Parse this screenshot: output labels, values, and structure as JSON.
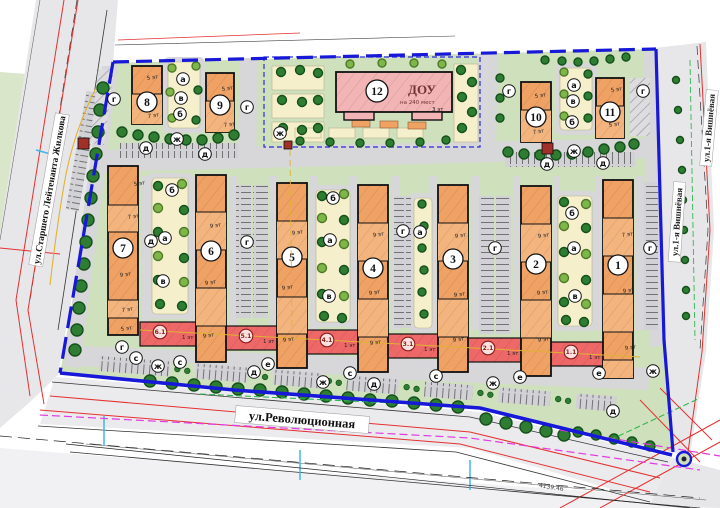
{
  "streets": {
    "left": "ул.Старшего Лейтенанта Жилкова",
    "bottom": "ул.Революционная",
    "right_lower": "ул.1-я Вишнёвая",
    "right_upper": "ул.1-я Вишнёвая"
  },
  "dimension_note": "4139.46",
  "dou": {
    "number": "12",
    "name": "ДОУ",
    "capacity": "на 240 мест",
    "floors": "3 эт"
  },
  "colors": {
    "site_green": "#cfe0bd",
    "light_green": "#dce8cc",
    "courtyard_cream": "#f5efcb",
    "building_orange": "#f0a164",
    "building_orange_light": "#f3b47e",
    "building_pink": "#f2b4b4",
    "commercial_red": "#ee6868",
    "boundary_blue": "#1718d8",
    "fence_blue": "#2a2ae0",
    "road_gray": "#d7d7da",
    "street_gray": "#e7e7ea",
    "tree_dark": "#2f7d32",
    "tree_dark_edge": "#14501a",
    "tree_light": "#7fb649",
    "tree_light_edge": "#4d7a28",
    "tp_red": "#a03028",
    "utility_red": "#e53030",
    "utility_magenta": "#e23ae2",
    "utility_yellow": "#e0b232",
    "utility_cyan": "#3fb6e8",
    "utility_green": "#2eb84e"
  },
  "plan": {
    "lanes": [
      142,
      188,
      230,
      270,
      310,
      350,
      392,
      430,
      472,
      513,
      553,
      595,
      636
    ],
    "courts": [
      [
        152,
        178,
        36,
        136
      ],
      [
        316,
        190,
        34,
        132
      ],
      [
        414,
        198,
        18,
        130
      ],
      [
        558,
        196,
        34,
        130
      ],
      [
        168,
        62,
        32,
        66
      ],
      [
        560,
        68,
        32,
        62
      ]
    ],
    "buildings": [
      {
        "id": "b7",
        "label": "7",
        "x": 108,
        "y": 166,
        "w": 30,
        "h": 169,
        "divs": [
          205,
          232,
          300,
          318
        ],
        "cx": 123,
        "cy": 248
      },
      {
        "id": "b6",
        "label": "6",
        "x": 196,
        "y": 175,
        "w": 30,
        "h": 187,
        "divs": [
          212,
          250,
          288,
          326
        ],
        "cx": 211,
        "cy": 251
      },
      {
        "id": "b5",
        "label": "5",
        "x": 277,
        "y": 183,
        "w": 30,
        "h": 185,
        "divs": [
          221,
          259,
          297,
          334
        ],
        "cx": 292,
        "cy": 257
      },
      {
        "id": "b4",
        "label": "4",
        "x": 358,
        "y": 185,
        "w": 30,
        "h": 187,
        "divs": [
          223,
          261,
          299,
          337
        ],
        "cx": 373,
        "cy": 268
      },
      {
        "id": "b3",
        "label": "3",
        "x": 438,
        "y": 185,
        "w": 30,
        "h": 187,
        "divs": [
          223,
          261,
          299,
          337
        ],
        "cx": 453,
        "cy": 259
      },
      {
        "id": "b2",
        "label": "2",
        "x": 521,
        "y": 186,
        "w": 30,
        "h": 190,
        "divs": [
          224,
          262,
          300,
          338
        ],
        "cx": 536,
        "cy": 264
      },
      {
        "id": "b1",
        "label": "1",
        "x": 603,
        "y": 180,
        "w": 30,
        "h": 198,
        "divs": [
          218,
          256,
          294,
          332,
          360
        ],
        "cx": 618,
        "cy": 265
      },
      {
        "id": "b8",
        "label": "8",
        "x": 132,
        "y": 66,
        "w": 30,
        "h": 58,
        "divs": [
          94
        ],
        "cx": 147,
        "cy": 102
      },
      {
        "id": "b9",
        "label": "9",
        "x": 206,
        "y": 73,
        "w": 28,
        "h": 59,
        "divs": [
          101
        ],
        "cx": 220,
        "cy": 105
      },
      {
        "id": "b10",
        "label": "10",
        "x": 521,
        "y": 82,
        "w": 30,
        "h": 60,
        "divs": [
          110
        ],
        "cx": 536,
        "cy": 117
      },
      {
        "id": "b11",
        "label": "11",
        "x": 596,
        "y": 78,
        "w": 28,
        "h": 60,
        "divs": [
          106
        ],
        "cx": 610,
        "cy": 112
      }
    ],
    "red_sections": [
      {
        "num": "6.1",
        "floors": "1 эт",
        "x": 140,
        "y": 322,
        "w": 56
      },
      {
        "num": "5.1",
        "floors": "1 эт",
        "x": 226,
        "y": 326,
        "w": 51
      },
      {
        "num": "4.1",
        "floors": "1 эт",
        "x": 307,
        "y": 330,
        "w": 51
      },
      {
        "num": "3.1",
        "floors": "1 эт",
        "x": 388,
        "y": 334,
        "w": 50
      },
      {
        "num": "2.1",
        "floors": "1 эт",
        "x": 468,
        "y": 338,
        "w": 53
      },
      {
        "num": "1.1",
        "floors": "1 эт",
        "x": 551,
        "y": 342,
        "w": 52
      }
    ],
    "floor_labels": [
      [
        "5 эт",
        134,
        186
      ],
      [
        "7 эт",
        128,
        219
      ],
      [
        "9 эт",
        120,
        277
      ],
      [
        "7 эт",
        122,
        312
      ],
      [
        "5 эт",
        121,
        331
      ],
      [
        "9 эт",
        210,
        228
      ],
      [
        "9 эт",
        205,
        285
      ],
      [
        "9 эт",
        203,
        338
      ],
      [
        "9 эт",
        292,
        235
      ],
      [
        "9 эт",
        282,
        290
      ],
      [
        "9 эт",
        283,
        342
      ],
      [
        "9 эт",
        373,
        237
      ],
      [
        "9 эт",
        369,
        295
      ],
      [
        "9 эт",
        370,
        345
      ],
      [
        "9 эт",
        455,
        238
      ],
      [
        "9 эт",
        454,
        297
      ],
      [
        "9 эт",
        453,
        342
      ],
      [
        "9 эт",
        538,
        238
      ],
      [
        "9 эт",
        537,
        295
      ],
      [
        "9 эт",
        538,
        342
      ],
      [
        "7 эт",
        622,
        237
      ],
      [
        "9 эт",
        623,
        293
      ],
      [
        "9 эт",
        625,
        350
      ],
      [
        "5 эт",
        147,
        80
      ],
      [
        "7 эт",
        148,
        118
      ],
      [
        "5 эт",
        222,
        91
      ],
      [
        "7 эт",
        224,
        127
      ],
      [
        "5 эт",
        535,
        98
      ],
      [
        "7 эт",
        533,
        134
      ],
      [
        "5 эт",
        611,
        92
      ],
      [
        "5 эт",
        609,
        127
      ]
    ],
    "letters": [
      [
        "г",
        114,
        99
      ],
      [
        "ж",
        177,
        139
      ],
      [
        "д",
        146,
        148
      ],
      [
        "д",
        205,
        154
      ],
      [
        "а",
        183,
        79
      ],
      [
        "в",
        181,
        98
      ],
      [
        "б",
        180,
        114
      ],
      [
        "г",
        247,
        107
      ],
      [
        "ж",
        280,
        133
      ],
      [
        "г",
        509,
        91
      ],
      [
        "г",
        643,
        91
      ],
      [
        "ж",
        574,
        151
      ],
      [
        "д",
        547,
        164
      ],
      [
        "д",
        603,
        163
      ],
      [
        "а",
        574,
        85
      ],
      [
        "в",
        573,
        101
      ],
      [
        "б",
        572,
        122
      ],
      [
        "д",
        151,
        241
      ],
      [
        "г",
        247,
        242
      ],
      [
        "г",
        403,
        231
      ],
      [
        "г",
        495,
        248
      ],
      [
        "г",
        650,
        248
      ],
      [
        "б",
        172,
        190
      ],
      [
        "а",
        165,
        238
      ],
      [
        "в",
        163,
        281
      ],
      [
        "б",
        333,
        198
      ],
      [
        "а",
        330,
        240
      ],
      [
        "в",
        329,
        296
      ],
      [
        "а",
        420,
        232
      ],
      [
        "б",
        572,
        213
      ],
      [
        "а",
        574,
        248
      ],
      [
        "в",
        575,
        296
      ],
      [
        "г",
        122,
        347
      ],
      [
        "с",
        136,
        358
      ],
      [
        "ж",
        158,
        366
      ],
      [
        "с",
        180,
        362
      ],
      [
        "д",
        254,
        372
      ],
      [
        "е",
        268,
        364
      ],
      [
        "ж",
        323,
        382
      ],
      [
        "с",
        350,
        373
      ],
      [
        "д",
        374,
        384
      ],
      [
        "с",
        436,
        376
      ],
      [
        "ж",
        493,
        383
      ],
      [
        "е",
        520,
        377
      ],
      [
        "е",
        599,
        373
      ],
      [
        "ж",
        653,
        371
      ],
      [
        "д",
        613,
        411
      ]
    ],
    "trees": [
      [
        103,
        88,
        6,
        "d"
      ],
      [
        100,
        110,
        6,
        "d"
      ],
      [
        98,
        132,
        6,
        "d"
      ],
      [
        96,
        154,
        6,
        "d"
      ],
      [
        93,
        176,
        6,
        "d"
      ],
      [
        91,
        198,
        6,
        "d"
      ],
      [
        88,
        220,
        6,
        "d"
      ],
      [
        86,
        242,
        6,
        "d"
      ],
      [
        84,
        264,
        6,
        "d"
      ],
      [
        81,
        286,
        6,
        "d"
      ],
      [
        79,
        308,
        6,
        "d"
      ],
      [
        77,
        330,
        6,
        "d"
      ],
      [
        75,
        350,
        6,
        "d"
      ],
      [
        150,
        381,
        6,
        "d"
      ],
      [
        172,
        383,
        6,
        "d"
      ],
      [
        194,
        385,
        6,
        "d"
      ],
      [
        216,
        387,
        6,
        "d"
      ],
      [
        238,
        389,
        6,
        "d"
      ],
      [
        260,
        390,
        6,
        "d"
      ],
      [
        282,
        392,
        6,
        "d"
      ],
      [
        304,
        394,
        6,
        "d"
      ],
      [
        326,
        396,
        6,
        "d"
      ],
      [
        348,
        398,
        6,
        "d"
      ],
      [
        370,
        400,
        6,
        "d"
      ],
      [
        392,
        401,
        6,
        "d"
      ],
      [
        414,
        403,
        6,
        "d"
      ],
      [
        436,
        405,
        6,
        "d"
      ],
      [
        458,
        407,
        6,
        "d"
      ],
      [
        486,
        419,
        6,
        "d"
      ],
      [
        506,
        423,
        6,
        "d"
      ],
      [
        526,
        427,
        6,
        "d"
      ],
      [
        546,
        431,
        6,
        "d"
      ],
      [
        564,
        435,
        6,
        "d"
      ],
      [
        578,
        432,
        5,
        "d"
      ],
      [
        596,
        435,
        5,
        "d"
      ],
      [
        614,
        439,
        5,
        "d"
      ],
      [
        632,
        442,
        5,
        "d"
      ],
      [
        650,
        446,
        5,
        "d"
      ],
      [
        122,
        132,
        5,
        "d"
      ],
      [
        138,
        135,
        5,
        "d"
      ],
      [
        154,
        137,
        5,
        "d"
      ],
      [
        170,
        139,
        5,
        "d"
      ],
      [
        186,
        140,
        5,
        "d"
      ],
      [
        202,
        140,
        5,
        "d"
      ],
      [
        218,
        138,
        5,
        "d"
      ],
      [
        234,
        135,
        5,
        "d"
      ],
      [
        172,
        68,
        4,
        "l"
      ],
      [
        196,
        66,
        4,
        "l"
      ],
      [
        170,
        92,
        4,
        "l"
      ],
      [
        198,
        90,
        4,
        "d"
      ],
      [
        172,
        118,
        4,
        "l"
      ],
      [
        196,
        120,
        4,
        "d"
      ],
      [
        508,
        152,
        5,
        "d"
      ],
      [
        524,
        154,
        5,
        "d"
      ],
      [
        540,
        155,
        5,
        "d"
      ],
      [
        556,
        155,
        5,
        "d"
      ],
      [
        572,
        154,
        5,
        "d"
      ],
      [
        588,
        152,
        5,
        "d"
      ],
      [
        604,
        149,
        5,
        "d"
      ],
      [
        620,
        147,
        5,
        "d"
      ],
      [
        634,
        144,
        5,
        "d"
      ],
      [
        564,
        72,
        4,
        "l"
      ],
      [
        588,
        74,
        4,
        "d"
      ],
      [
        564,
        94,
        4,
        "l"
      ],
      [
        588,
        96,
        4,
        "d"
      ],
      [
        564,
        116,
        4,
        "l"
      ],
      [
        588,
        118,
        4,
        "d"
      ],
      [
        545,
        60,
        4,
        "d"
      ],
      [
        562,
        61,
        4,
        "d"
      ],
      [
        578,
        62,
        4,
        "d"
      ],
      [
        594,
        61,
        4,
        "d"
      ],
      [
        610,
        59,
        4,
        "d"
      ],
      [
        626,
        57,
        4,
        "d"
      ],
      [
        500,
        78,
        4,
        "d"
      ],
      [
        500,
        98,
        4,
        "d"
      ],
      [
        500,
        118,
        4,
        "d"
      ],
      [
        281,
        72,
        4.5,
        "d"
      ],
      [
        300,
        70,
        4.5,
        "d"
      ],
      [
        318,
        73,
        4.5,
        "d"
      ],
      [
        282,
        100,
        4.5,
        "d"
      ],
      [
        302,
        102,
        4.5,
        "d"
      ],
      [
        318,
        100,
        4.5,
        "d"
      ],
      [
        283,
        128,
        4.5,
        "d"
      ],
      [
        302,
        130,
        4.5,
        "d"
      ],
      [
        318,
        128,
        4.5,
        "d"
      ],
      [
        461,
        70,
        4.5,
        "d"
      ],
      [
        472,
        82,
        4.5,
        "d"
      ],
      [
        462,
        97,
        4.5,
        "d"
      ],
      [
        472,
        112,
        4.5,
        "d"
      ],
      [
        462,
        128,
        4.5,
        "d"
      ],
      [
        300,
        141,
        4,
        "d"
      ],
      [
        330,
        142,
        4,
        "d"
      ],
      [
        360,
        143,
        4,
        "d"
      ],
      [
        390,
        143,
        4,
        "d"
      ],
      [
        420,
        142,
        4,
        "d"
      ],
      [
        446,
        140,
        4,
        "d"
      ],
      [
        350,
        64,
        4,
        "l"
      ],
      [
        382,
        63,
        4,
        "l"
      ],
      [
        414,
        63,
        4,
        "l"
      ],
      [
        442,
        64,
        4,
        "l"
      ],
      [
        158,
        186,
        4.5,
        "d"
      ],
      [
        182,
        184,
        4.5,
        "l"
      ],
      [
        158,
        208,
        4.5,
        "l"
      ],
      [
        184,
        210,
        4.5,
        "d"
      ],
      [
        158,
        232,
        4.5,
        "d"
      ],
      [
        184,
        232,
        4.5,
        "l"
      ],
      [
        158,
        256,
        4.5,
        "l"
      ],
      [
        184,
        258,
        4.5,
        "d"
      ],
      [
        158,
        280,
        4.5,
        "d"
      ],
      [
        184,
        282,
        4.5,
        "l"
      ],
      [
        160,
        304,
        4.5,
        "d"
      ],
      [
        182,
        306,
        4.5,
        "d"
      ],
      [
        322,
        196,
        4.5,
        "d"
      ],
      [
        344,
        194,
        4.5,
        "l"
      ],
      [
        322,
        218,
        4.5,
        "l"
      ],
      [
        344,
        220,
        4.5,
        "d"
      ],
      [
        322,
        242,
        4.5,
        "d"
      ],
      [
        344,
        244,
        4.5,
        "l"
      ],
      [
        322,
        268,
        4.5,
        "l"
      ],
      [
        344,
        270,
        4.5,
        "d"
      ],
      [
        322,
        294,
        4.5,
        "d"
      ],
      [
        344,
        296,
        4.5,
        "l"
      ],
      [
        324,
        316,
        4.5,
        "d"
      ],
      [
        342,
        318,
        4.5,
        "d"
      ],
      [
        422,
        204,
        4,
        "d"
      ],
      [
        424,
        226,
        4,
        "d"
      ],
      [
        422,
        248,
        4,
        "d"
      ],
      [
        424,
        270,
        4,
        "d"
      ],
      [
        422,
        292,
        4,
        "d"
      ],
      [
        424,
        314,
        4,
        "d"
      ],
      [
        564,
        202,
        4.5,
        "d"
      ],
      [
        586,
        204,
        4.5,
        "l"
      ],
      [
        564,
        226,
        4.5,
        "l"
      ],
      [
        586,
        228,
        4.5,
        "d"
      ],
      [
        564,
        252,
        4.5,
        "d"
      ],
      [
        586,
        254,
        4.5,
        "l"
      ],
      [
        564,
        278,
        4.5,
        "l"
      ],
      [
        586,
        280,
        4.5,
        "d"
      ],
      [
        564,
        302,
        4.5,
        "d"
      ],
      [
        586,
        304,
        4.5,
        "l"
      ],
      [
        566,
        320,
        4.5,
        "d"
      ],
      [
        584,
        322,
        4.5,
        "d"
      ],
      [
        676,
        80,
        3.5,
        "d"
      ],
      [
        678,
        110,
        3.5,
        "d"
      ],
      [
        680,
        140,
        3.5,
        "d"
      ],
      [
        682,
        170,
        3.5,
        "d"
      ],
      [
        683,
        200,
        3.5,
        "d"
      ],
      [
        684,
        230,
        3.5,
        "d"
      ],
      [
        685,
        260,
        3.5,
        "d"
      ],
      [
        686,
        290,
        3.5,
        "d"
      ],
      [
        686,
        316,
        3.5,
        "d"
      ]
    ]
  }
}
